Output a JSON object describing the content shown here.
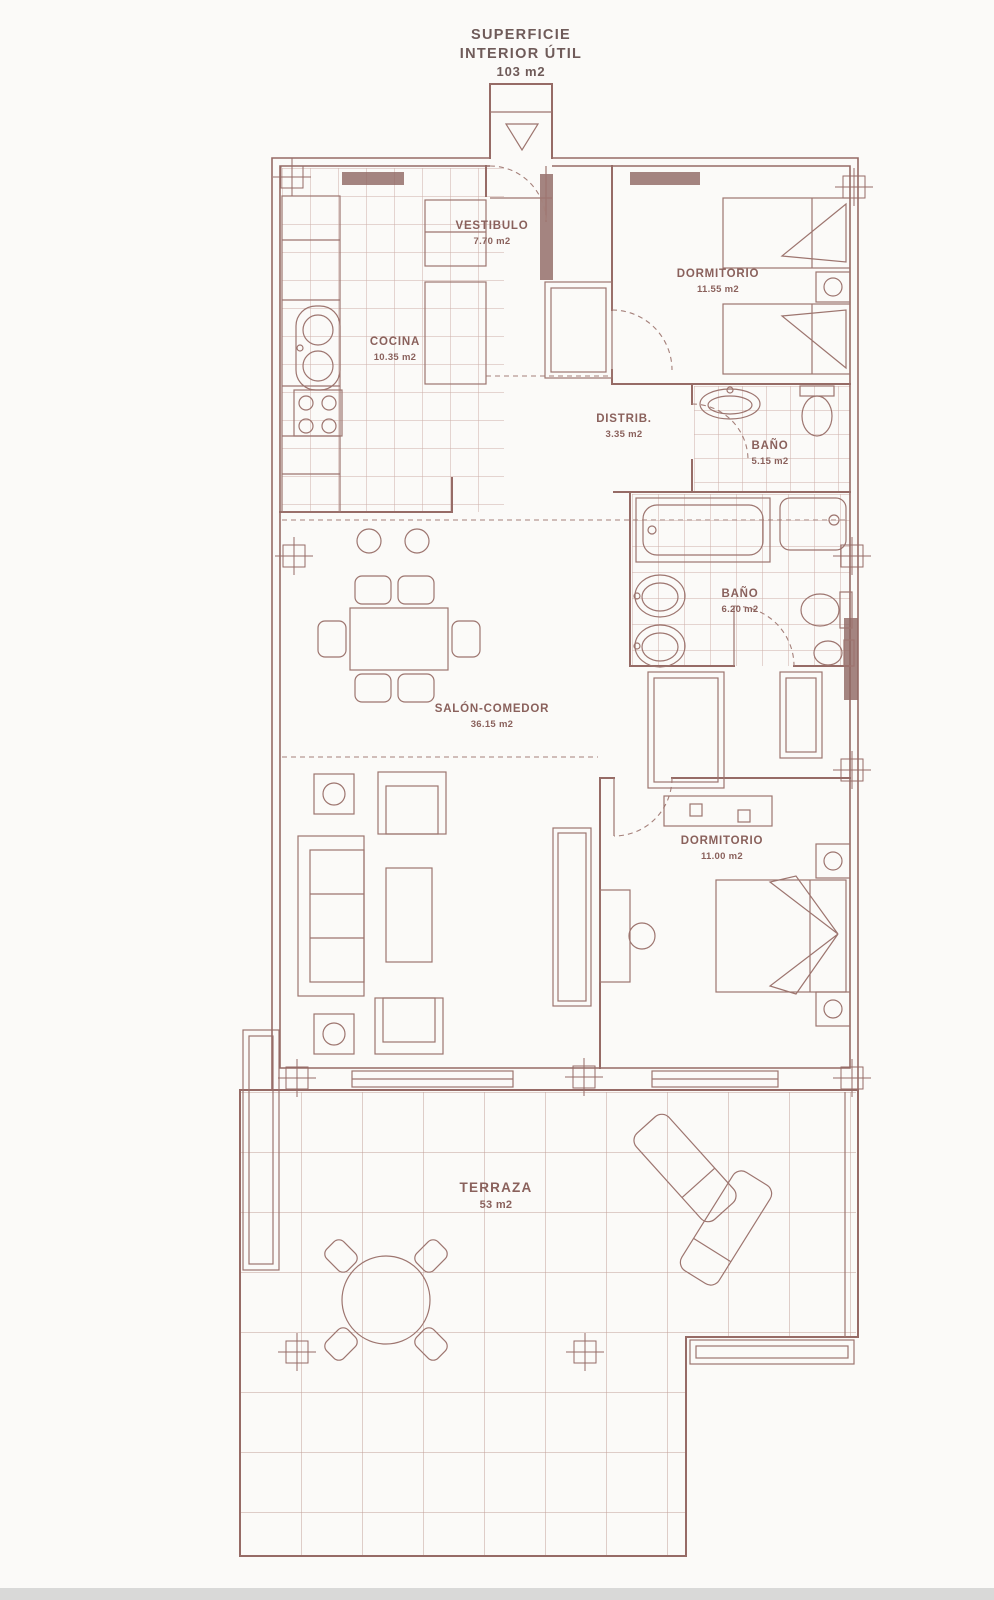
{
  "title": {
    "line1": "SUPERFICIE",
    "line2": "INTERIOR ÚTIL",
    "line3": "103 m2"
  },
  "rooms": {
    "vestibulo": {
      "name": "VESTIBULO",
      "area": "7.70 m2"
    },
    "cocina": {
      "name": "COCINA",
      "area": "10.35 m2"
    },
    "dormitorio1": {
      "name": "DORMITORIO",
      "area": "11.55 m2"
    },
    "distribuidor": {
      "name": "DISTRIB.",
      "area": "3.35 m2"
    },
    "bano1": {
      "name": "BAÑO",
      "area": "5.15 m2"
    },
    "bano2": {
      "name": "BAÑO",
      "area": "6.20 m2"
    },
    "salon": {
      "name": "SALÓN-COMEDOR",
      "area": "36.15 m2"
    },
    "dormitorio2": {
      "name": "DORMITORIO",
      "area": "11.00 m2"
    },
    "terraza": {
      "name": "TERRAZA",
      "area": "53 m2"
    }
  },
  "colors": {
    "wall_line": "#966b66",
    "label_text": "#8a615c",
    "tile_line": "#c9aaa3",
    "footer_bar": "#d9d9d8",
    "background": "#fbfaf8"
  }
}
